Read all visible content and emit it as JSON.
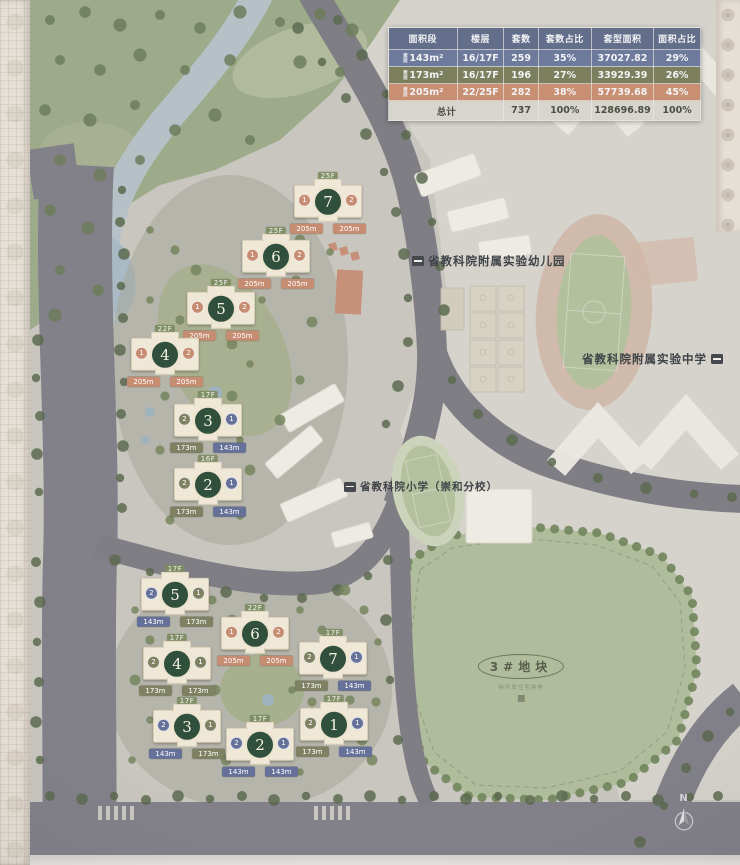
{
  "table": {
    "header_color": "#626e8a",
    "total_color": "#d8d5cf",
    "total_text_color": "#4b5043",
    "headers": [
      "面积段",
      "楼层",
      "套数",
      "套数占比",
      "套型面积",
      "面积占比"
    ],
    "rows": [
      {
        "prefix": "建面",
        "area": "143m²",
        "floors": "16/17F",
        "units": "259",
        "units_pct": "35%",
        "gfa": "37027.82",
        "gfa_pct": "29%",
        "color": "#6d7a9c"
      },
      {
        "prefix": "建面",
        "area": "173m²",
        "floors": "16/17F",
        "units": "196",
        "units_pct": "27%",
        "gfa": "33929.39",
        "gfa_pct": "26%",
        "color": "#7c7f5e"
      },
      {
        "prefix": "建面",
        "area": "205m²",
        "floors": "22/25F",
        "units": "282",
        "units_pct": "38%",
        "gfa": "57739.68",
        "gfa_pct": "45%",
        "color": "#c88f73"
      }
    ],
    "total": {
      "label": "总计",
      "units": "737",
      "units_pct": "100%",
      "gfa": "128696.89",
      "gfa_pct": "100%"
    }
  },
  "labels": {
    "kindergarten": "省教科院附属实验幼儿园",
    "middle_school": "省教科院附属实验中学",
    "primary_school": "省教科院小学（崇和分校）",
    "plot3_title": "3#地块",
    "plot3_caption": "待开发住宅用地",
    "compass_n": "N"
  },
  "area_colors": {
    "143m": "#66719a",
    "173m": "#7f8163",
    "205m": "#c68d72"
  },
  "clusters": {
    "upper": {
      "buildings": [
        {
          "num": "7",
          "x": 328,
          "y": 204,
          "floor": "25F",
          "left": {
            "unit": "1",
            "area": "205m"
          },
          "right": {
            "unit": "2",
            "area": "205m"
          }
        },
        {
          "num": "6",
          "x": 276,
          "y": 259,
          "floor": "25F",
          "left": {
            "unit": "1",
            "area": "205m"
          },
          "right": {
            "unit": "2",
            "area": "205m"
          }
        },
        {
          "num": "5",
          "x": 221,
          "y": 311,
          "floor": "25F",
          "left": {
            "unit": "1",
            "area": "205m"
          },
          "right": {
            "unit": "2",
            "area": "205m"
          }
        },
        {
          "num": "4",
          "x": 165,
          "y": 357,
          "floor": "22F",
          "left": {
            "unit": "1",
            "area": "205m"
          },
          "right": {
            "unit": "2",
            "area": "205m"
          }
        },
        {
          "num": "3",
          "x": 208,
          "y": 423,
          "floor": "17F",
          "left": {
            "unit": "2",
            "area": "173m"
          },
          "right": {
            "unit": "1",
            "area": "143m"
          }
        },
        {
          "num": "2",
          "x": 208,
          "y": 487,
          "floor": "16F",
          "left": {
            "unit": "2",
            "area": "173m"
          },
          "right": {
            "unit": "1",
            "area": "143m"
          }
        }
      ]
    },
    "lower": {
      "buildings": [
        {
          "num": "5",
          "x": 175,
          "y": 597,
          "floor": "17F",
          "left": {
            "unit": "2",
            "area": "143m"
          },
          "right": {
            "unit": "1",
            "area": "173m"
          }
        },
        {
          "num": "6",
          "x": 255,
          "y": 636,
          "floor": "22F",
          "left": {
            "unit": "1",
            "area": "205m"
          },
          "right": {
            "unit": "2",
            "area": "205m"
          }
        },
        {
          "num": "4",
          "x": 177,
          "y": 666,
          "floor": "17F",
          "left": {
            "unit": "2",
            "area": "173m"
          },
          "right": {
            "unit": "1",
            "area": "173m"
          }
        },
        {
          "num": "7",
          "x": 333,
          "y": 661,
          "floor": "17F",
          "left": {
            "unit": "2",
            "area": "173m"
          },
          "right": {
            "unit": "1",
            "area": "143m"
          }
        },
        {
          "num": "3",
          "x": 187,
          "y": 729,
          "floor": "17F",
          "left": {
            "unit": "2",
            "area": "143m"
          },
          "right": {
            "unit": "1",
            "area": "173m"
          }
        },
        {
          "num": "2",
          "x": 260,
          "y": 747,
          "floor": "17F",
          "left": {
            "unit": "2",
            "area": "143m"
          },
          "right": {
            "unit": "1",
            "area": "143m"
          }
        },
        {
          "num": "1",
          "x": 334,
          "y": 727,
          "floor": "17F",
          "left": {
            "unit": "2",
            "area": "173m"
          },
          "right": {
            "unit": "1",
            "area": "143m"
          }
        }
      ]
    }
  }
}
